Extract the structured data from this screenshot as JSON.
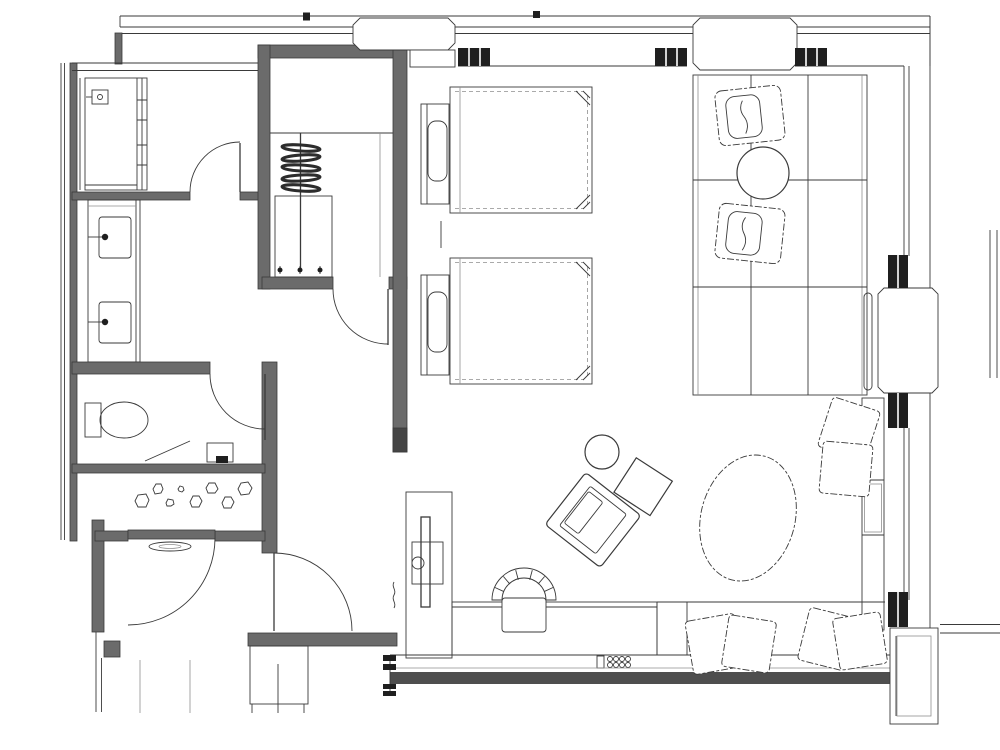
{
  "canvas": {
    "width": "1000",
    "height": "750"
  },
  "colors": {
    "background": "#ffffff",
    "line": "#3a3a3a",
    "line_light": "#8f8f8f",
    "wall": "#6b6b6b",
    "wall_dark": "#454545",
    "hatch": "#1f1f1f",
    "glass": "#4e4e4e"
  },
  "legend": {
    "drawing_type": "hotel-guestroom-floor-plan",
    "rooms": [
      "bathroom",
      "vanity-corridor",
      "toilet-room",
      "walk-in-closet",
      "entry-hall",
      "bedroom",
      "sitting-area"
    ],
    "furniture_icons": [
      "shower-stall-icon",
      "sink-icon",
      "faucet-icon",
      "toilet-icon",
      "pebble-decor-icon",
      "hanger-rack-icon",
      "twin-bed-icon",
      "pillow-icon",
      "tv-icon",
      "desk-icon",
      "desk-chair-icon",
      "lounge-chair-icon",
      "round-side-table-icon",
      "side-table-icon",
      "oval-ottoman-icon",
      "grid-rug-icon",
      "armchair-icon",
      "coffee-table-icon",
      "window-bench-icon",
      "throw-pillow-icon",
      "door-swing-icon",
      "column-icon",
      "window-wall-icon"
    ]
  }
}
